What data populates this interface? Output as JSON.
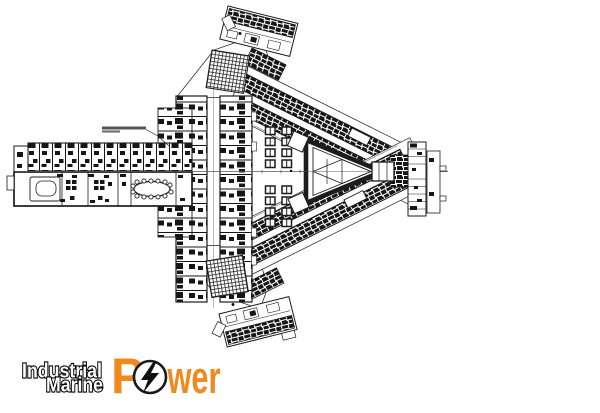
{
  "window": {
    "width": 600,
    "height": 413,
    "background": "#ffffff"
  },
  "floor_plan": {
    "ink": "#1c1c1c",
    "fill": "#ffffff",
    "centerline_color": "#5a5a5a",
    "corridor_line_color": "#777777"
  },
  "logo": {
    "word_top": "Industrial",
    "word_bottom": "Marine",
    "power_initial": "P",
    "power_suffix": "wer",
    "orange": "#F18A1E",
    "stacked_fill": "#ffffff",
    "stacked_outline": "#000000",
    "bolt_color": "#111111",
    "bolt_ring_fill": "#ffffff"
  }
}
